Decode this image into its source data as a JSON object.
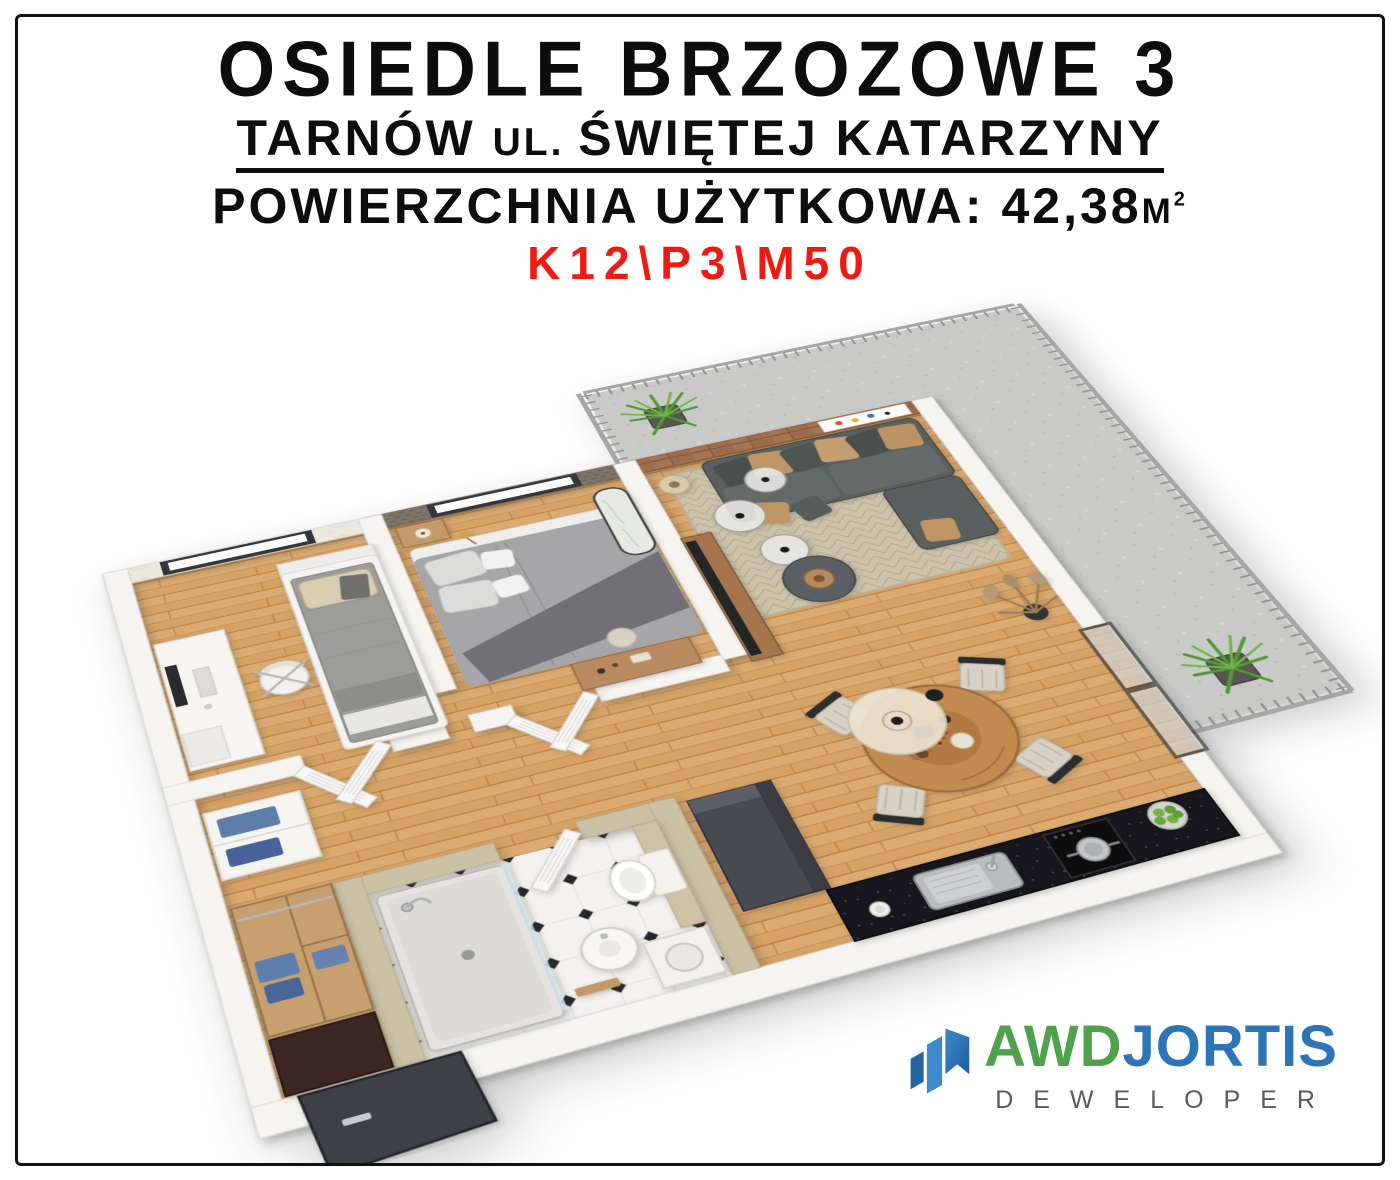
{
  "header": {
    "title": "OSIEDLE BRZOZOWE 3",
    "subtitle_city": "TARNÓW ",
    "subtitle_ul": "UL. ",
    "subtitle_street": "ŚWIĘTEJ KATARZYNY",
    "area_label": "POWIERZCHNIA UŻYTKOWA: ",
    "area_value": "42,38",
    "area_unit": "M",
    "area_unit_sup": "2",
    "unit_code": "K12\\P3\\M50"
  },
  "logo": {
    "brand_part1": "AWD",
    "brand_part2": "JORTIS",
    "tagline": "DEWELOPER",
    "mark": "rising-bars-flag-icon"
  },
  "floorplan": {
    "alt": "3D isometric render of a 42,38 m2 two-bedroom apartment with living/dining room, kitchen counter, bathroom, hall wardrobe and L-shaped terrace with railing and plants"
  },
  "palette": {
    "frame-border": "#111111",
    "title-color": "#0d0d0d",
    "unit-code-red": "#ec1c15",
    "logo-green": "#4ea24b",
    "logo-blue": "#2d74b9",
    "logo-blue-light": "#3e8bcb",
    "logo-gray": "#595a5c",
    "wood-floor": "#d7a266",
    "terrace-concrete": "#c9c9c7",
    "wall-white": "#f5f4f1",
    "sofa-gray": "#5a615e",
    "pillow-tan": "#bf9566",
    "rug-beige": "#cdc3ab"
  }
}
